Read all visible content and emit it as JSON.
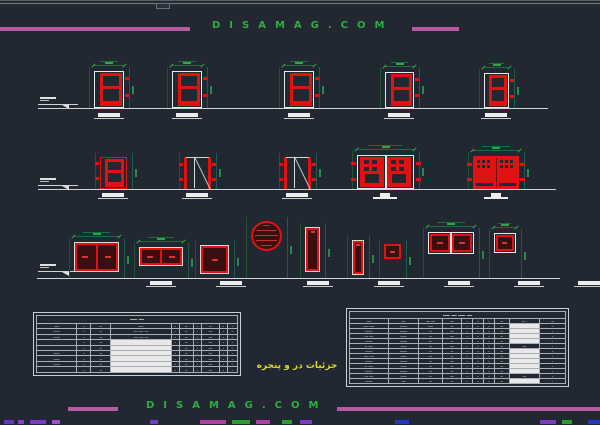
{
  "palette": {
    "bg": "#222831",
    "red": "#e01212",
    "red_dark_fill": "#39100f",
    "white_line": "#e8e8e8",
    "ground_line": "#cfd3d6",
    "dim_green": "#1b5437",
    "dim_green_bright": "#2fa644",
    "magenta": "#b55ca4",
    "banner_green": "#2eae41",
    "label_yellow": "#d6d62b"
  },
  "top_banner": {
    "text": "DISAMAG.COM"
  },
  "bottom_banner": {
    "text": "DISAMAG.COM"
  },
  "footer_label": {
    "text": "جزئیات در و پنجره"
  },
  "drawings": {
    "rows": [
      {
        "name": "door-elevations-top",
        "baseline": {
          "x1": 38,
          "x2": 548,
          "y": 108
        },
        "marker": {
          "x": 38,
          "y": 97
        },
        "items": [
          {
            "v": "panel2",
            "x": 94,
            "y": 71,
            "w": 30,
            "h": 37,
            "dim": true
          },
          {
            "v": "panel2",
            "x": 172,
            "y": 71,
            "w": 30,
            "h": 37,
            "dim": true
          },
          {
            "v": "panel2",
            "x": 284,
            "y": 71,
            "w": 30,
            "h": 37,
            "dim": true
          },
          {
            "v": "panel2",
            "x": 385,
            "y": 72,
            "w": 29,
            "h": 36,
            "dim": true
          },
          {
            "v": "panel2",
            "x": 484,
            "y": 73,
            "w": 25,
            "h": 35,
            "dim": true
          }
        ],
        "thresholds": [
          {
            "x": 98
          },
          {
            "x": 176
          },
          {
            "x": 288
          },
          {
            "x": 388
          },
          {
            "x": 485
          }
        ],
        "thr_y": 113
      },
      {
        "name": "door-elevations-middle",
        "baseline": {
          "x1": 38,
          "x2": 556,
          "y": 189
        },
        "marker": {
          "x": 38,
          "y": 178
        },
        "items": [
          {
            "v": "panel2red",
            "x": 100,
            "y": 157,
            "w": 27,
            "h": 32
          },
          {
            "v": "swing",
            "x": 184,
            "y": 157,
            "w": 27,
            "h": 32
          },
          {
            "v": "swing",
            "x": 284,
            "y": 157,
            "w": 27,
            "h": 32
          },
          {
            "v": "double_glazed",
            "x": 357,
            "y": 155,
            "w": 57,
            "h": 34,
            "dim": true
          },
          {
            "v": "double_red",
            "x": 473,
            "y": 156,
            "w": 46,
            "h": 33,
            "dim": true
          }
        ],
        "thresholds": [
          {
            "x": 102
          },
          {
            "x": 186
          },
          {
            "x": 286
          },
          {
            "x": 374,
            "pedestal": true
          },
          {
            "x": 485,
            "pedestal": true
          }
        ],
        "thr_y": 193
      },
      {
        "name": "window-elevations",
        "baseline": {
          "x1": 37,
          "x2": 560,
          "y": 278
        },
        "marker": {
          "x": 38,
          "y": 264
        },
        "items": [
          {
            "v": "pane2",
            "x": 74,
            "y": 242,
            "w": 45,
            "h": 30,
            "dim": true
          },
          {
            "v": "pane2",
            "x": 139,
            "y": 247,
            "w": 44,
            "h": 19,
            "dim": true
          },
          {
            "v": "pane1",
            "x": 200,
            "y": 245,
            "w": 29,
            "h": 29
          },
          {
            "v": "circle",
            "x": 251,
            "y": 221,
            "w": 31,
            "h": 30
          },
          {
            "v": "slit",
            "x": 305,
            "y": 227,
            "w": 15,
            "h": 45
          },
          {
            "v": "slit",
            "x": 352,
            "y": 240,
            "w": 12,
            "h": 35
          },
          {
            "v": "pane1red",
            "x": 384,
            "y": 244,
            "w": 17,
            "h": 15
          },
          {
            "v": "pane2white",
            "x": 428,
            "y": 232,
            "w": 46,
            "h": 22,
            "dim": true
          },
          {
            "v": "pane1white",
            "x": 494,
            "y": 233,
            "w": 22,
            "h": 20,
            "dim": true
          }
        ],
        "thresholds": [
          {
            "x": 150
          },
          {
            "x": 220
          },
          {
            "x": 307
          },
          {
            "x": 378
          },
          {
            "x": 448
          },
          {
            "x": 518
          },
          {
            "x": 578
          }
        ],
        "thr_y": 281
      }
    ]
  },
  "tables": {
    "left": {
      "x": 36,
      "y": 315,
      "w": 202,
      "h": 58,
      "title": "ـــ ــــ",
      "col_widths": [
        20,
        7,
        10,
        30,
        4,
        7,
        4,
        9,
        4,
        5
      ],
      "headers": [
        "ــــ",
        "ـ",
        "ــ",
        "ــــ",
        "ـ",
        "ــ",
        "ـ",
        "ــ",
        "ـ",
        "ـ"
      ],
      "rows": [
        [
          "ـــــ",
          "ـ",
          "ــ",
          "ـــ ــــ ـــ",
          "ـ",
          "ــ",
          "ـ",
          "ـــ",
          "ـ",
          "ـ"
        ],
        [
          "ـــــ",
          "ـ",
          "ــ",
          "ـــ ـــ ــــ",
          "ـ",
          "ــ",
          "ـ",
          "ـــ",
          "ـ",
          "ـ"
        ],
        [
          "",
          "ـ",
          "ــ",
          "#ــــــــــ",
          "ـ",
          "ــ",
          "ـ",
          "ـــ",
          "ـ",
          "ـ"
        ],
        [
          "",
          "ـ",
          "ــ",
          "#ـــــــــ",
          "",
          "ــ",
          "ـ",
          "ـــ",
          "ـ",
          "ـ"
        ],
        [
          "ـــــ",
          "ـ",
          "ــ",
          "#ــــــــ",
          "ـ",
          "ــ",
          "ـ",
          "ـــ",
          "ـ",
          "ـ"
        ],
        [
          "ـــــ",
          "ـ",
          "ــ",
          "#ـــــــ",
          "ـ",
          "ــ",
          "ـ",
          "ـــ",
          "ـ",
          "ـ"
        ],
        [
          "ـــــ",
          "ـ",
          "ــ",
          "#ــــــــ",
          "ـ",
          "ــ",
          "ـ",
          "ـــ",
          "ـ",
          "ـ"
        ],
        [
          "",
          "ـ",
          "ــ",
          "#ــــــ",
          "ـ",
          "ــ",
          "ـ",
          "ـــ",
          "ـ",
          "ـ"
        ]
      ]
    },
    "right": {
      "x": 349,
      "y": 311,
      "w": 217,
      "h": 68,
      "title": "ـــ ــــ ـــ ــــ",
      "col_widths": [
        18,
        14,
        11,
        9,
        5,
        5,
        5,
        7,
        14,
        12
      ],
      "headers": [
        "ــــ",
        "ـــ",
        "ـــ ـــ",
        "ـــ",
        "ـ",
        "ـ",
        "ـ",
        "ــ",
        "ـ ــ",
        "ــ"
      ],
      "rows": [
        [
          "ــــ ــــ",
          "ــــــ",
          "ــــ",
          "ــ",
          "ـ",
          "ـ",
          "ـ",
          "ــ",
          "#ــــــ",
          "ـ"
        ],
        [
          "ــــــ",
          "ــــــ",
          "ــ",
          "ـــ",
          "ـ",
          "ـ",
          "ـ",
          "ــ",
          "#ــــــ",
          "ـ"
        ],
        [
          "ـــ ـــ",
          "ـــــ",
          "ــ",
          "ـــ",
          "ـ",
          "ـ",
          "ـ",
          "ــ",
          "#ـــــ",
          "ـ"
        ],
        [
          "ــــــ",
          "ــــــ",
          "ـــ",
          "ــ",
          "ـ",
          "ـ",
          "ـ",
          "ــ",
          "#ــــــ",
          "ـ"
        ],
        [
          "ــــ ــ",
          "ـــــ",
          "ــ",
          "ـــ",
          "ـ",
          "ـ",
          "ـ",
          "ــ",
          "ـــ",
          "ـ"
        ],
        [
          "ــــــ",
          "ــــــ",
          "ــ",
          "ــ",
          "ـ",
          "ـ",
          "ـ",
          "ــ",
          "#ــــــ",
          "ـ"
        ],
        [
          "ـــ ــــ",
          "ـــــ",
          "ـــ",
          "ــ",
          "ـ",
          "ـ",
          "ـ",
          "ــ",
          "#ـــــ",
          "ـ"
        ],
        [
          "ــــــ",
          "ــــــ",
          "ــ",
          "ـــ",
          "ـ",
          "ـ",
          "ـ",
          "ــ",
          "#ــــــ",
          "ـ"
        ],
        [
          "ــــ ــ",
          "ـــــ",
          "ــ",
          "ــ",
          "ـ",
          "ـ",
          "ـ",
          "ــ",
          "#ـــــ",
          "ـ"
        ],
        [
          "ــــــ",
          "ــــــ",
          "ـــ",
          "ــ",
          "ـ",
          "ـ",
          "ـ",
          "ــ",
          "#ــــــ",
          "ـ"
        ],
        [
          "ـــ ـــ",
          "ـــــ",
          "ــ",
          "ـــ",
          "ـ",
          "ـ",
          "ـ",
          "ــ",
          "ـــ",
          "ـ"
        ],
        [
          "ــــــ",
          "ـــ",
          "ــ",
          "ــ",
          "ـ",
          "ـ",
          "ـ",
          "ــ",
          "#ـــــ",
          "ـ"
        ]
      ]
    }
  },
  "cutoff_marks": [
    {
      "x": 4,
      "w": 10,
      "c": "#6a35c2"
    },
    {
      "x": 18,
      "w": 6,
      "c": "#8a3fd0"
    },
    {
      "x": 30,
      "w": 16,
      "c": "#7b3bc6"
    },
    {
      "x": 52,
      "w": 8,
      "c": "#a14fd0"
    },
    {
      "x": 150,
      "w": 8,
      "c": "#7b3bc6"
    },
    {
      "x": 200,
      "w": 26,
      "c": "#b03fa0"
    },
    {
      "x": 232,
      "w": 18,
      "c": "#27a02c"
    },
    {
      "x": 256,
      "w": 14,
      "c": "#b03fa0"
    },
    {
      "x": 282,
      "w": 10,
      "c": "#27a02c"
    },
    {
      "x": 300,
      "w": 12,
      "c": "#7b3bc6"
    },
    {
      "x": 395,
      "w": 14,
      "c": "#2438c8"
    },
    {
      "x": 540,
      "w": 16,
      "c": "#7b3bc6"
    },
    {
      "x": 562,
      "w": 10,
      "c": "#27a02c"
    },
    {
      "x": 588,
      "w": 12,
      "c": "#2438c8"
    }
  ]
}
